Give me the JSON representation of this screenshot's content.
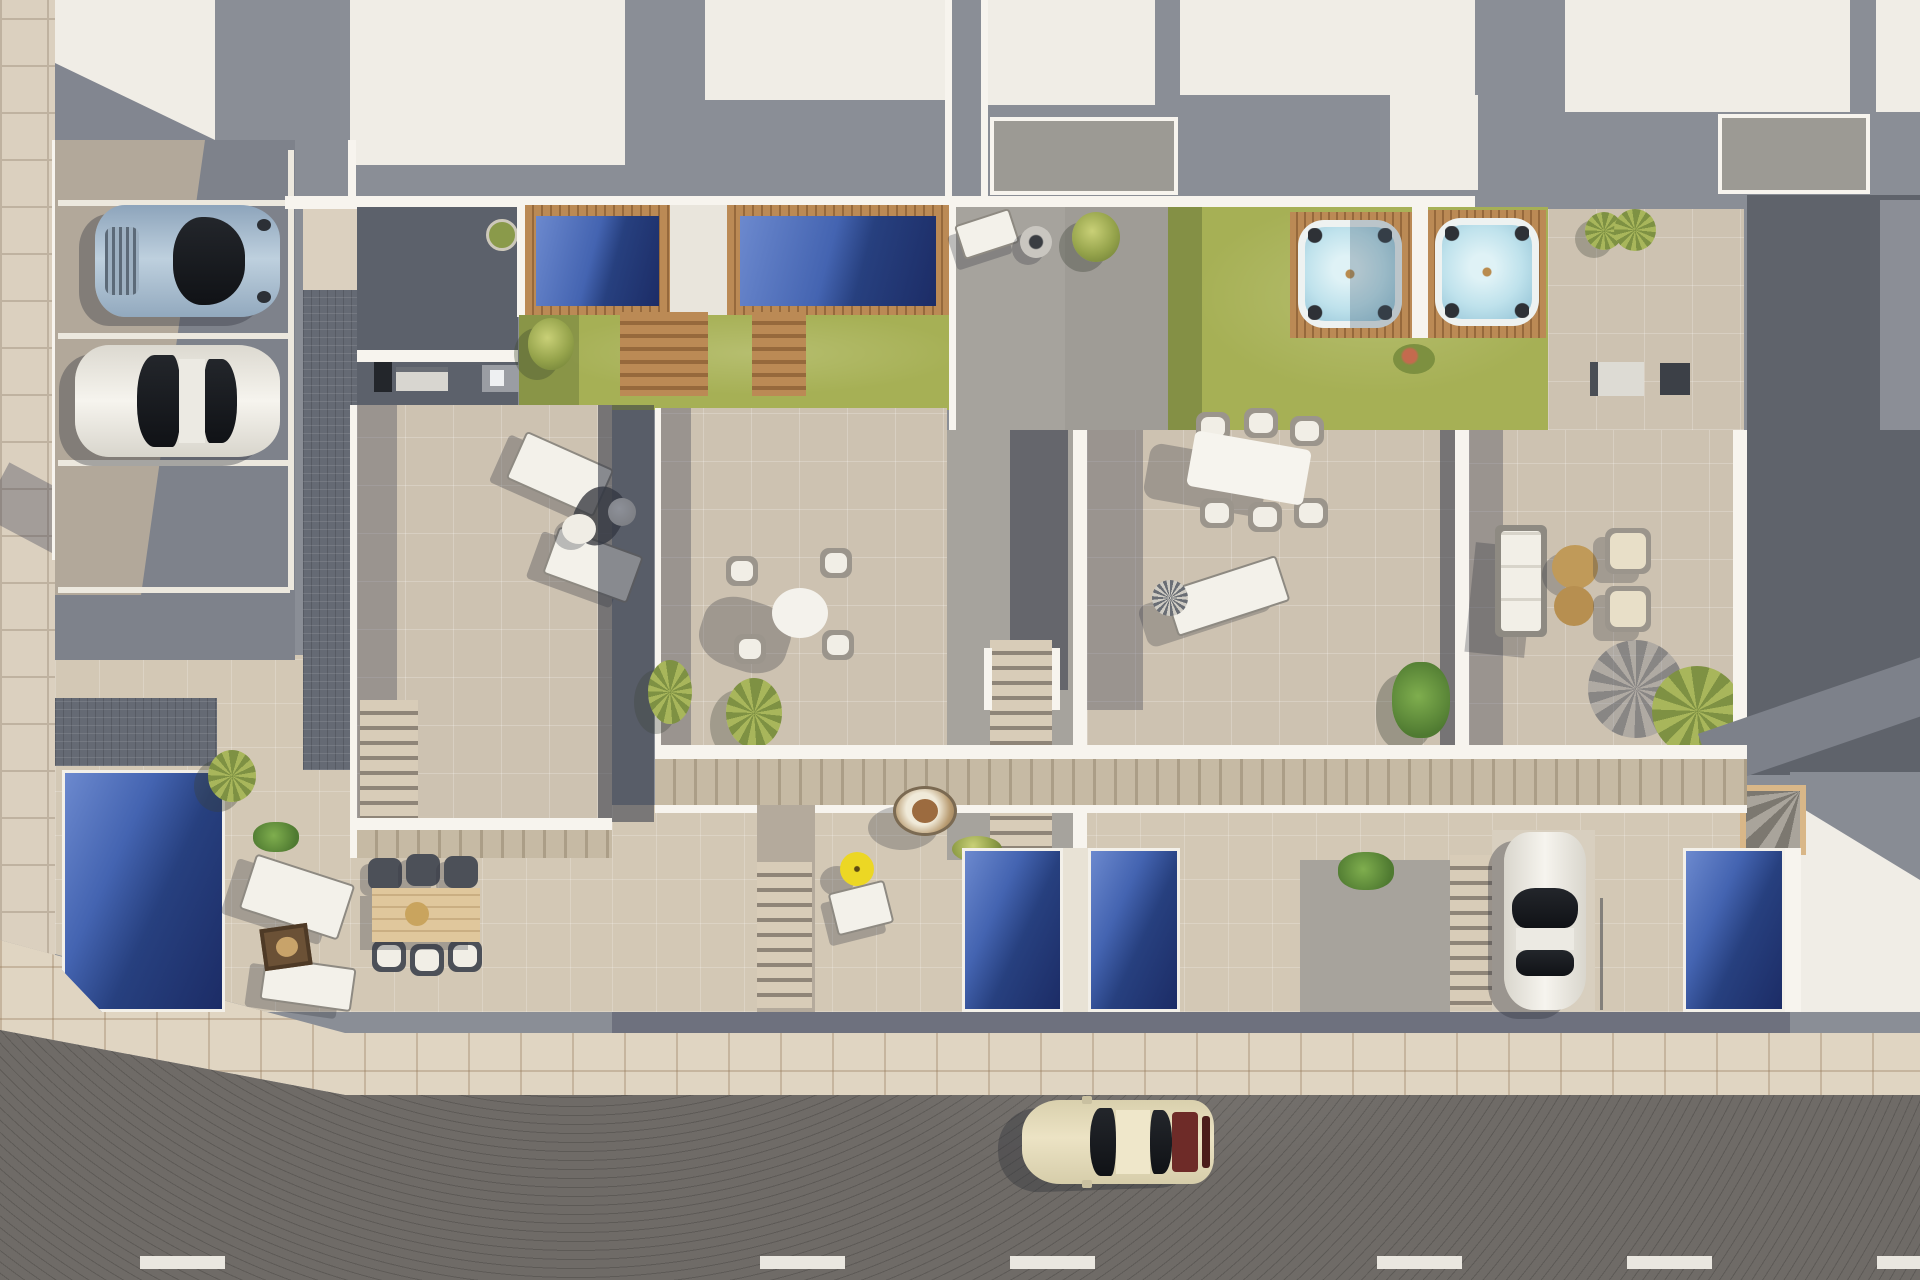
{
  "scene": {
    "kind": "aerial-architectural-render",
    "description": "Top-down 3D render of a row of four new-build townhouses with rooftop pools, lawns with hot tubs, tiled roof terraces with outdoor furniture, ground-floor patios with plunge pools, a parking area with two cars, a driveway car and a street with a driving car",
    "units": 4,
    "no_visible_text": true
  },
  "palette": {
    "bg_gray": "#8a8e96",
    "roof_white": "#f0ede6",
    "parapet_white": "#f7f4ee",
    "terrace_recessed": "#9c9a94",
    "charcoal": "#5c616b",
    "gray_pave": "#a6a39d",
    "parking_tan": "#b2a89a",
    "parking_shadow": "#7e828b",
    "stall_white": "#ece8de",
    "walkway_tile": "#dbd0bf",
    "walkway_grout": "#bfb2a0",
    "cobble": "#656a74",
    "terrace_beige": "#cdc2b1",
    "ground_beige": "#d3c8b5",
    "sidewalk": "#e0d5c2",
    "lawn": "#a6b055",
    "lawn_shadow": "#7f8c42",
    "wood": "#bb8a55",
    "wood_dark": "#96693c",
    "porch_wood": "#c6baa4",
    "porch_wood_d": "#ab9e87",
    "pool_light": "#6c89ce",
    "pool_mid": "#4464b1",
    "pool_navy": "#27407f",
    "pool_deep": "#1c2c66",
    "tub_water": "#bfe2ec",
    "tub_rim": "#eef2f1",
    "umbrella_yellow": "#ecd724",
    "road": "#6f6b67",
    "road_dash": "#eae7e0",
    "car_cream": "#ece3c4",
    "car_blue": "#a4b8ca",
    "car_white": "#f0eee8",
    "car_red": "#6e2b28",
    "neighbor_roof": "#5f636b"
  },
  "inventory": {
    "rooftop_pools": 2,
    "hot_tubs": 2,
    "ground_pools": 4,
    "wooden_pool_steps": 2,
    "staircases": 5,
    "parking": {
      "stalls": 4,
      "occupied": 2
    },
    "vehicles": [
      {
        "name": "silver-blue-coupe",
        "location": "parking",
        "color_key": "car_blue"
      },
      {
        "name": "white-sedan",
        "location": "parking",
        "color_key": "car_white"
      },
      {
        "name": "white-hatchback",
        "location": "driveway",
        "color_key": "car_white"
      },
      {
        "name": "cream-classic-car",
        "location": "street",
        "color_key": "car_cream"
      }
    ],
    "furniture": [
      "two sun loungers with parasol and side table (unit-1 terrace)",
      "round dining table with four wicker chairs (unit-2 terrace)",
      "white dining table with six chairs (unit-3 terrace)",
      "wheeled sun lounger (unit-3 terrace)",
      "outdoor sofa, two armchairs and two round coffee tables (unit-4 terrace)",
      "wooden dining table with six dark chairs (ground patio)",
      "two loungers with fire table (ground patio)",
      "hanging egg chair, yellow parasol and lounger (unit-2 patio)"
    ],
    "vegetation": [
      "palms",
      "bushes",
      "monstera plants",
      "round planter"
    ],
    "street": {
      "asphalt": true,
      "dashed_center_line": true,
      "sidewalk_tiles": true
    }
  }
}
